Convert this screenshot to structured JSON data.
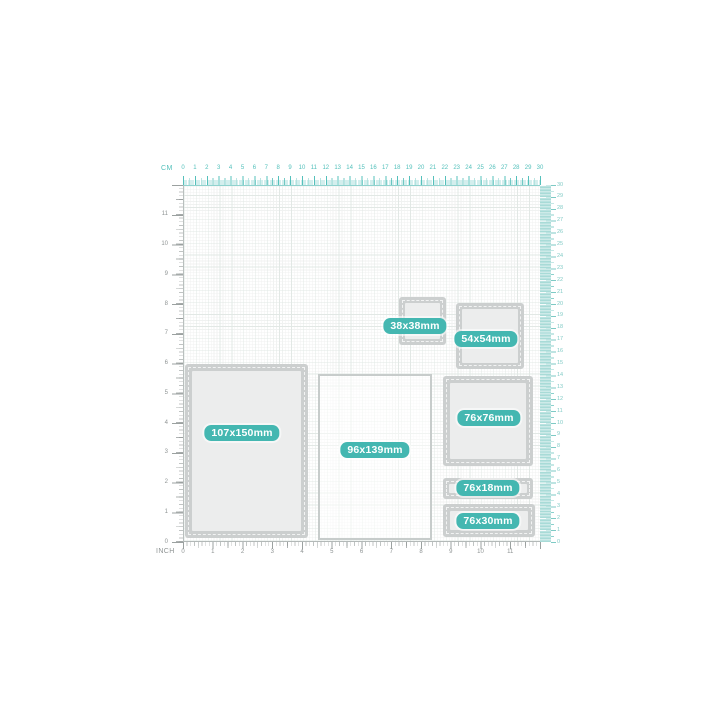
{
  "accent_color": "#44b7b1",
  "die_border_color": "#cccfcf",
  "rulers": {
    "cm_label": "CM",
    "inch_label": "INCH",
    "cm_numbers": [
      0,
      1,
      2,
      3,
      4,
      5,
      6,
      7,
      8,
      9,
      10,
      11,
      12,
      13,
      14,
      15,
      16,
      17,
      18,
      19,
      20,
      21,
      22,
      23,
      24,
      25,
      26,
      27,
      28,
      29,
      30
    ],
    "inch_numbers": [
      0,
      1,
      2,
      3,
      4,
      5,
      6,
      7,
      8,
      9,
      10,
      11
    ]
  },
  "dies": [
    {
      "name": "die-107x150",
      "label": "107x150mm",
      "style": "thick",
      "x": 185,
      "y": 364,
      "w": 123,
      "h": 174,
      "border": 7,
      "badge": {
        "cx": 242,
        "cy": 433
      }
    },
    {
      "name": "die-96x139",
      "label": "96x139mm",
      "style": "thin",
      "x": 318,
      "y": 374,
      "w": 114,
      "h": 166,
      "border": 2.5,
      "badge": {
        "cx": 375,
        "cy": 450
      }
    },
    {
      "name": "die-38x38",
      "label": "38x38mm",
      "style": "thick",
      "x": 399,
      "y": 297,
      "w": 47,
      "h": 48,
      "border": 6,
      "badge": {
        "cx": 415,
        "cy": 326
      }
    },
    {
      "name": "die-54x54",
      "label": "54x54mm",
      "style": "thick",
      "x": 456,
      "y": 303,
      "w": 68,
      "h": 66,
      "border": 6,
      "badge": {
        "cx": 486,
        "cy": 339
      }
    },
    {
      "name": "die-76x76",
      "label": "76x76mm",
      "style": "thick",
      "x": 443,
      "y": 376,
      "w": 90,
      "h": 90,
      "border": 7,
      "badge": {
        "cx": 489,
        "cy": 418
      }
    },
    {
      "name": "die-76x18",
      "label": "76x18mm",
      "style": "thick",
      "x": 443,
      "y": 478,
      "w": 90,
      "h": 21,
      "border": 6,
      "badge": {
        "cx": 488,
        "cy": 488
      }
    },
    {
      "name": "die-76x30",
      "label": "76x30mm",
      "style": "thick",
      "x": 443,
      "y": 504,
      "w": 92,
      "h": 33,
      "border": 7,
      "badge": {
        "cx": 488,
        "cy": 521
      }
    }
  ]
}
